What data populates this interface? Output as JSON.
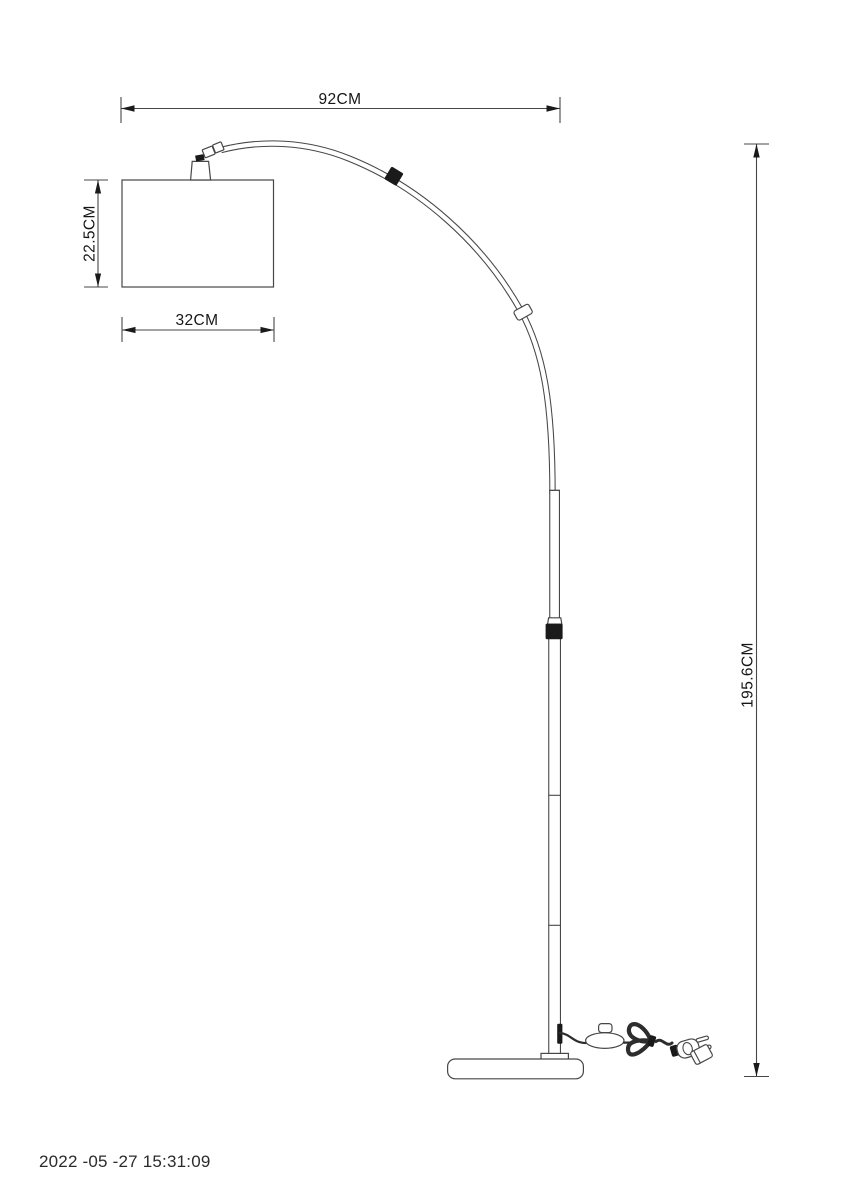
{
  "drawing": {
    "type": "technical-dimension-diagram",
    "subject": "arc floor lamp",
    "dimensions": {
      "overall_width": "92CM",
      "shade_height": "22.5CM",
      "shade_width": "32CM",
      "overall_height": "195.6CM"
    },
    "timestamp": "2022 -05 -27 15:31:09",
    "colors": {
      "line": "#474747",
      "dark_fill": "#1a1a1a",
      "text": "#161616",
      "background": "#ffffff"
    }
  }
}
